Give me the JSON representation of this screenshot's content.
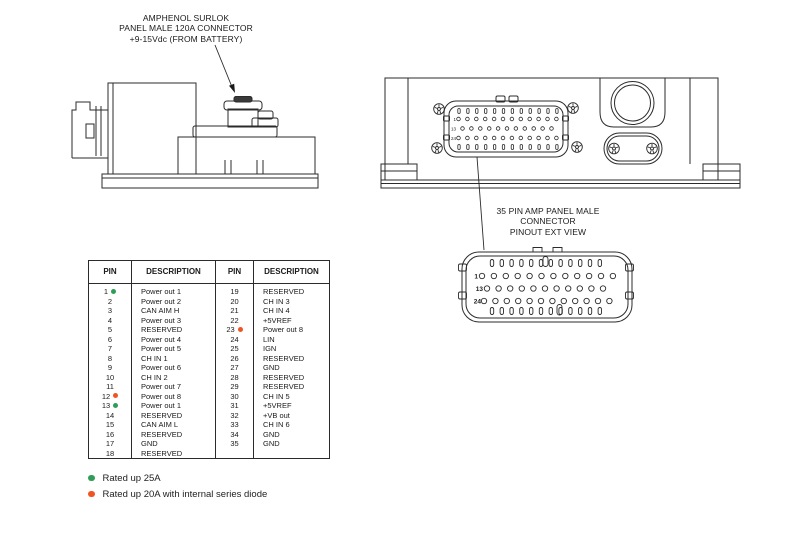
{
  "annotation_top": {
    "line1": "AMPHENOL SURLOK",
    "line2": "PANEL MALE 120A CONNECTOR",
    "line3": "+9-15Vdc (FROM BATTERY)"
  },
  "pinout_label": {
    "line1": "35 PIN AMP PANEL MALE",
    "line2": "CONNECTOR",
    "line3": "PINOUT EXT VIEW"
  },
  "device_connector": {
    "row_labels": [
      "1",
      "13",
      "24"
    ]
  },
  "pinout_view": {
    "row_labels": [
      "1",
      "13",
      "24"
    ],
    "row_pin_counts": [
      12,
      11,
      12
    ]
  },
  "pin_table": {
    "headers": [
      "PIN",
      "DESCRIPTION",
      "PIN",
      "DESCRIPTION"
    ],
    "rows": [
      {
        "pin_left": "1",
        "marker_left": "green",
        "desc_left": "Power out 1",
        "pin_right": "19",
        "marker_right": "",
        "desc_right": "RESERVED"
      },
      {
        "pin_left": "2",
        "marker_left": "",
        "desc_left": "Power out 2",
        "pin_right": "20",
        "marker_right": "",
        "desc_right": "CH IN 3"
      },
      {
        "pin_left": "3",
        "marker_left": "",
        "desc_left": "CAN AIM H",
        "pin_right": "21",
        "marker_right": "",
        "desc_right": "CH IN 4"
      },
      {
        "pin_left": "4",
        "marker_left": "",
        "desc_left": "Power out 3",
        "pin_right": "22",
        "marker_right": "",
        "desc_right": "+5VREF"
      },
      {
        "pin_left": "5",
        "marker_left": "",
        "desc_left": "RESERVED",
        "pin_right": "23",
        "marker_right": "orange",
        "desc_right": "Power out 8"
      },
      {
        "pin_left": "6",
        "marker_left": "",
        "desc_left": "Power out 4",
        "pin_right": "24",
        "marker_right": "",
        "desc_right": "LIN"
      },
      {
        "pin_left": "7",
        "marker_left": "",
        "desc_left": "Power out 5",
        "pin_right": "25",
        "marker_right": "",
        "desc_right": "IGN"
      },
      {
        "pin_left": "8",
        "marker_left": "",
        "desc_left": "CH IN 1",
        "pin_right": "26",
        "marker_right": "",
        "desc_right": "RESERVED"
      },
      {
        "pin_left": "9",
        "marker_left": "",
        "desc_left": "Power out 6",
        "pin_right": "27",
        "marker_right": "",
        "desc_right": "GND"
      },
      {
        "pin_left": "10",
        "marker_left": "",
        "desc_left": "CH IN 2",
        "pin_right": "28",
        "marker_right": "",
        "desc_right": "RESERVED"
      },
      {
        "pin_left": "11",
        "marker_left": "",
        "desc_left": "Power out 7",
        "pin_right": "29",
        "marker_right": "",
        "desc_right": "RESERVED"
      },
      {
        "pin_left": "12",
        "marker_left": "orange",
        "desc_left": "Power out 8",
        "pin_right": "30",
        "marker_right": "",
        "desc_right": "CH IN 5"
      },
      {
        "pin_left": "13",
        "marker_left": "green",
        "desc_left": "Power out 1",
        "pin_right": "31",
        "marker_right": "",
        "desc_right": "+5VREF"
      },
      {
        "pin_left": "14",
        "marker_left": "",
        "desc_left": "RESERVED",
        "pin_right": "32",
        "marker_right": "",
        "desc_right": "+VB out"
      },
      {
        "pin_left": "15",
        "marker_left": "",
        "desc_left": "CAN AIM L",
        "pin_right": "33",
        "marker_right": "",
        "desc_right": "CH IN 6"
      },
      {
        "pin_left": "16",
        "marker_left": "",
        "desc_left": "RESERVED",
        "pin_right": "34",
        "marker_right": "",
        "desc_right": "GND"
      },
      {
        "pin_left": "17",
        "marker_left": "",
        "desc_left": "GND",
        "pin_right": "35",
        "marker_right": "",
        "desc_right": "GND"
      },
      {
        "pin_left": "18",
        "marker_left": "",
        "desc_left": "RESERVED",
        "pin_right": "",
        "marker_right": "",
        "desc_right": ""
      }
    ]
  },
  "legend": [
    {
      "marker": "green",
      "label": "Rated up 25A"
    },
    {
      "marker": "orange",
      "label": "Rated up 20A with internal series diode"
    }
  ],
  "colors": {
    "green": "#2e9e57",
    "orange": "#f05423",
    "line": "#2b2b2b"
  }
}
